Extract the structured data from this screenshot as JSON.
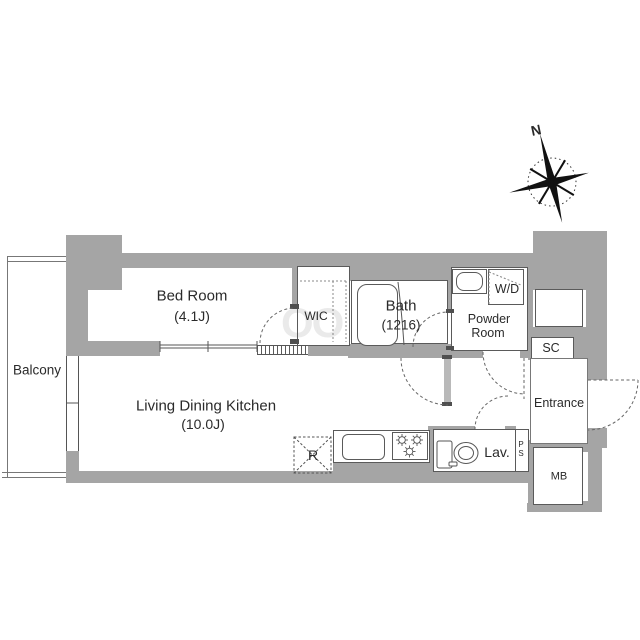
{
  "labels": {
    "bedroom_name": "Bed Room",
    "bedroom_size": "(4.1J)",
    "ldk_name": "Living Dining Kitchen",
    "ldk_size": "(10.0J)",
    "bath_name": "Bath",
    "bath_size": "(1216)",
    "powder_line1": "Powder",
    "powder_line2": "Room",
    "wic": "WIC",
    "wd": "W/D",
    "sc": "SC",
    "entrance": "Entrance",
    "mb": "MB",
    "ps_p": "P",
    "ps_s": "S",
    "lav": "Lav.",
    "balcony": "Balcony",
    "fridge": "R",
    "compass_north": "N",
    "watermark": "OO"
  },
  "colors": {
    "wall_fill": "#a5a5a5",
    "outline": "#5a5a5a",
    "text": "#2a2a2a",
    "dash": "#666666"
  }
}
